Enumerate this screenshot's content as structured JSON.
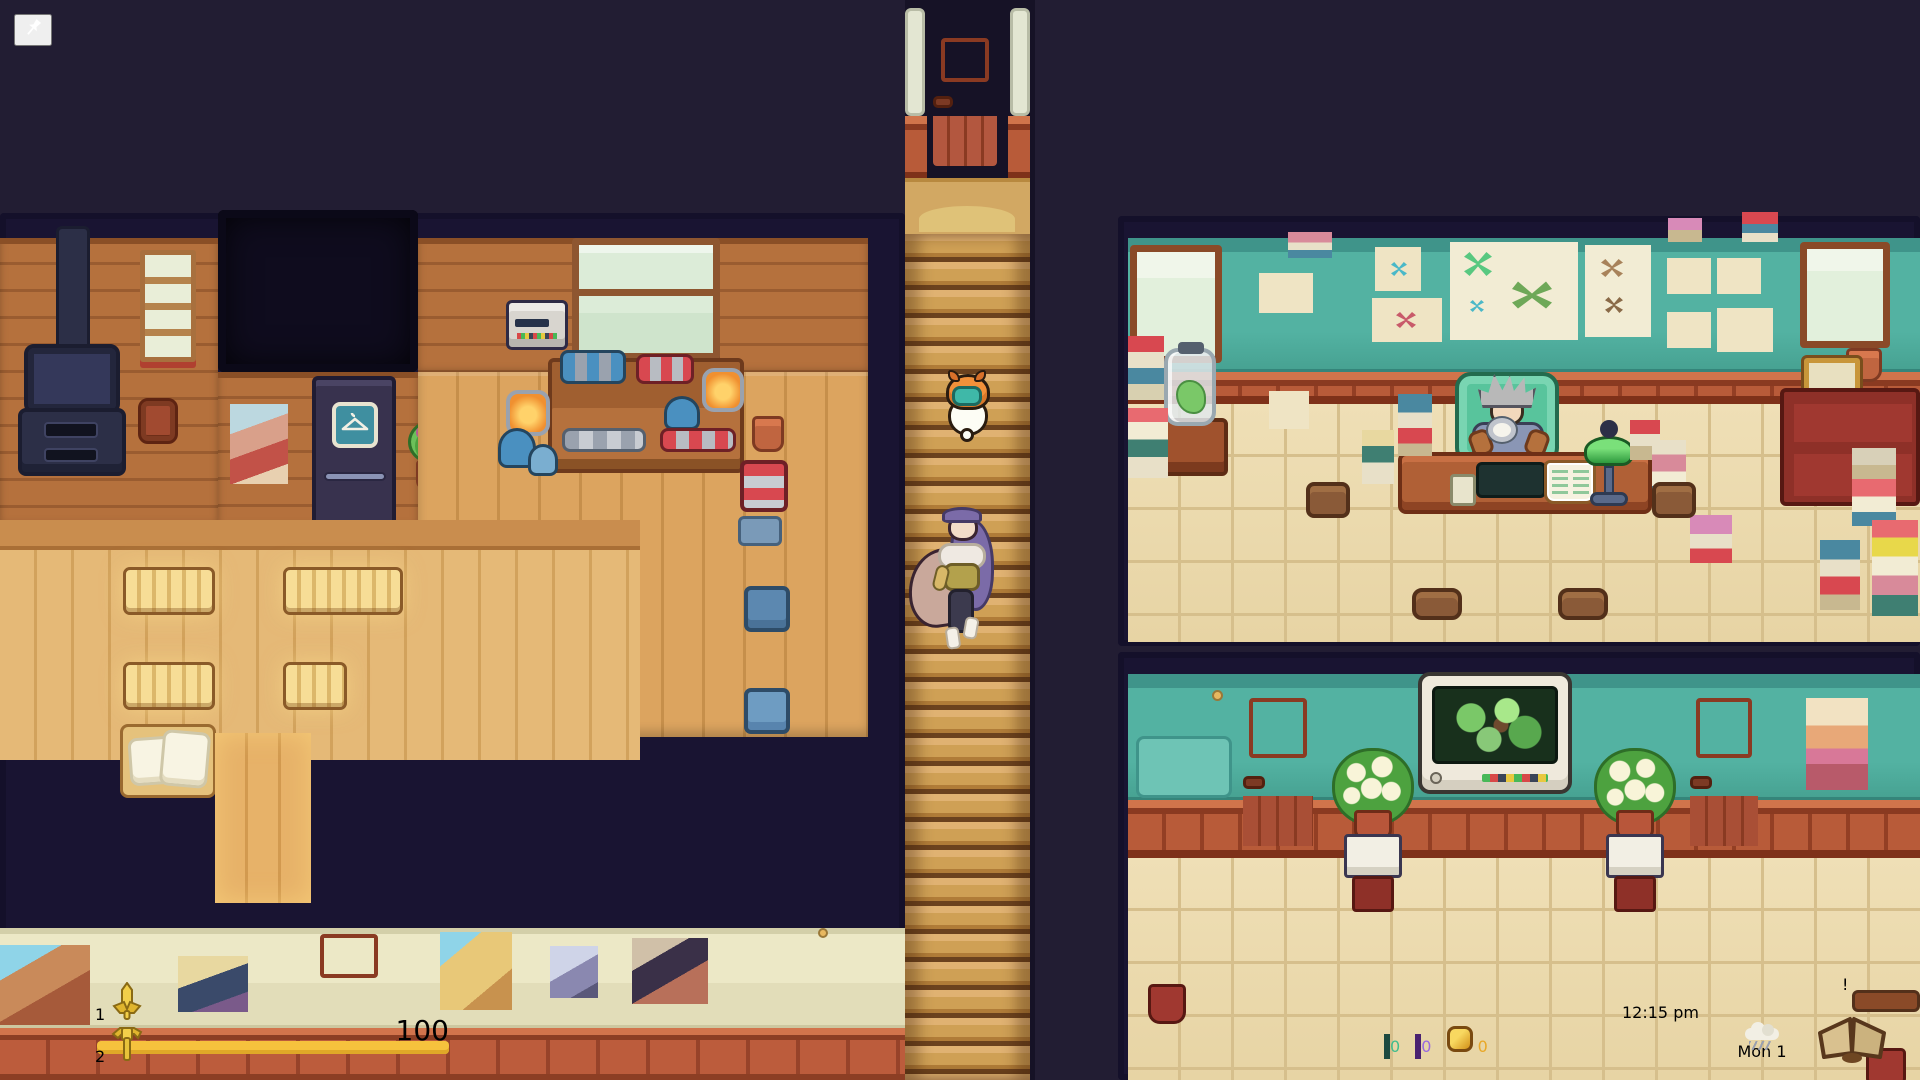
{
  "hud": {
    "pin_button": {
      "icon": "pushpin-icon"
    },
    "hotbar": {
      "slots": [
        {
          "key": "1",
          "item": "sword-icon",
          "selected": true
        },
        {
          "key": "2",
          "item": "hammer-icon",
          "selected": false
        }
      ]
    },
    "energy": {
      "value": "100",
      "percent": 100,
      "fill_color": "#f6c23d"
    },
    "currencies": [
      {
        "icon": "teal-gem-icon",
        "value": "0",
        "color": "#41bd8d"
      },
      {
        "icon": "purple-gem-icon",
        "value": "0",
        "color": "#9a6ae0"
      },
      {
        "icon": "gold-nugget-icon",
        "value": "0",
        "color": "#e9a827"
      }
    ],
    "clock": {
      "time": "12:15 pm",
      "weather_icon": "rain-cloud-icon",
      "date": "Mon 1",
      "journal_icon": "open-book-icon",
      "journal_alert": "!"
    }
  },
  "colors": {
    "accent_cyan": "#3ec9ec",
    "energy_yellow": "#f6c23d",
    "panel_slate": "#353c55",
    "background": "#221d33",
    "teal_wall": "#53b2a2",
    "wood_wall": "#b5713d"
  }
}
